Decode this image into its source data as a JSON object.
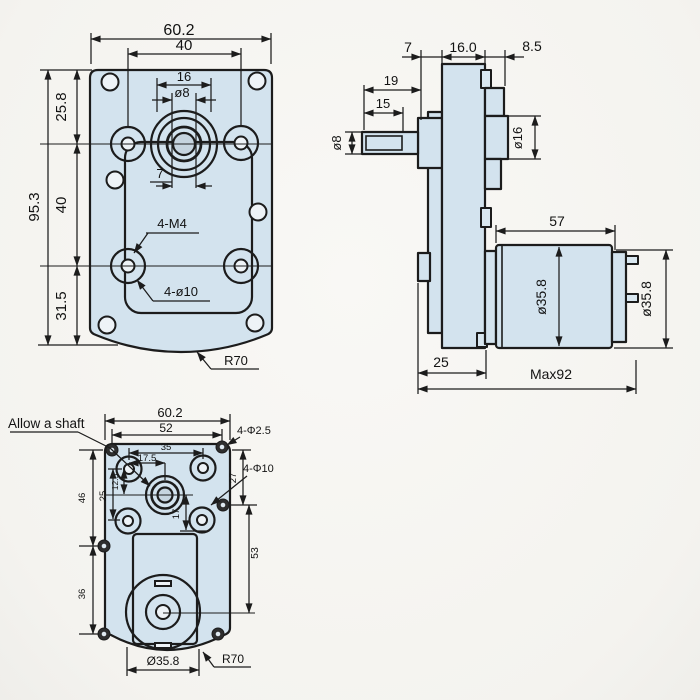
{
  "drawing": {
    "colors": {
      "paper": "#f7f6f3",
      "part_fill": "#d3e3ee",
      "line": "#1c1c1c"
    },
    "front_view": {
      "overall_width": "60.2",
      "hole_spacing_h": "40",
      "boss_width": "16",
      "shaft_dia": "ø8",
      "key_width": "7",
      "top_offset": "25.8",
      "overall_height": "95.3",
      "hole_spacing_v": "40",
      "bottom_offset": "31.5",
      "thread_callout": "4-M4",
      "hole_callout": "4-ø10",
      "corner_radius": "R70"
    },
    "side_view": {
      "cover_thickness": "7",
      "plate_thickness": "16.0",
      "boss_depth": "8.5",
      "shaft_length": "19",
      "shaft_flat_length": "15",
      "shaft_dia": "ø8",
      "boss_dia": "ø16",
      "motor_length": "57",
      "motor_dia": "ø35.8",
      "motor_rear_dia": "ø35.8",
      "base_offset": "25",
      "max_length": "Max92"
    },
    "back_view": {
      "note": "Allow a shaft",
      "overall_width": "60.2",
      "screw_spacing": "52",
      "hole_spacing_h": "35",
      "shaft_offset_h": "17.5",
      "shaft_offset_v": "12.5",
      "hole_spacing_v": "25",
      "left_top": "46",
      "left_bottom": "36",
      "center_down": "17",
      "right_top": "27",
      "right_mid": "53",
      "corner_hole_callout": "4-Φ2.5",
      "hole_callout": "4-Φ10",
      "motor_dia": "Ø35.8",
      "corner_radius": "R70"
    }
  }
}
